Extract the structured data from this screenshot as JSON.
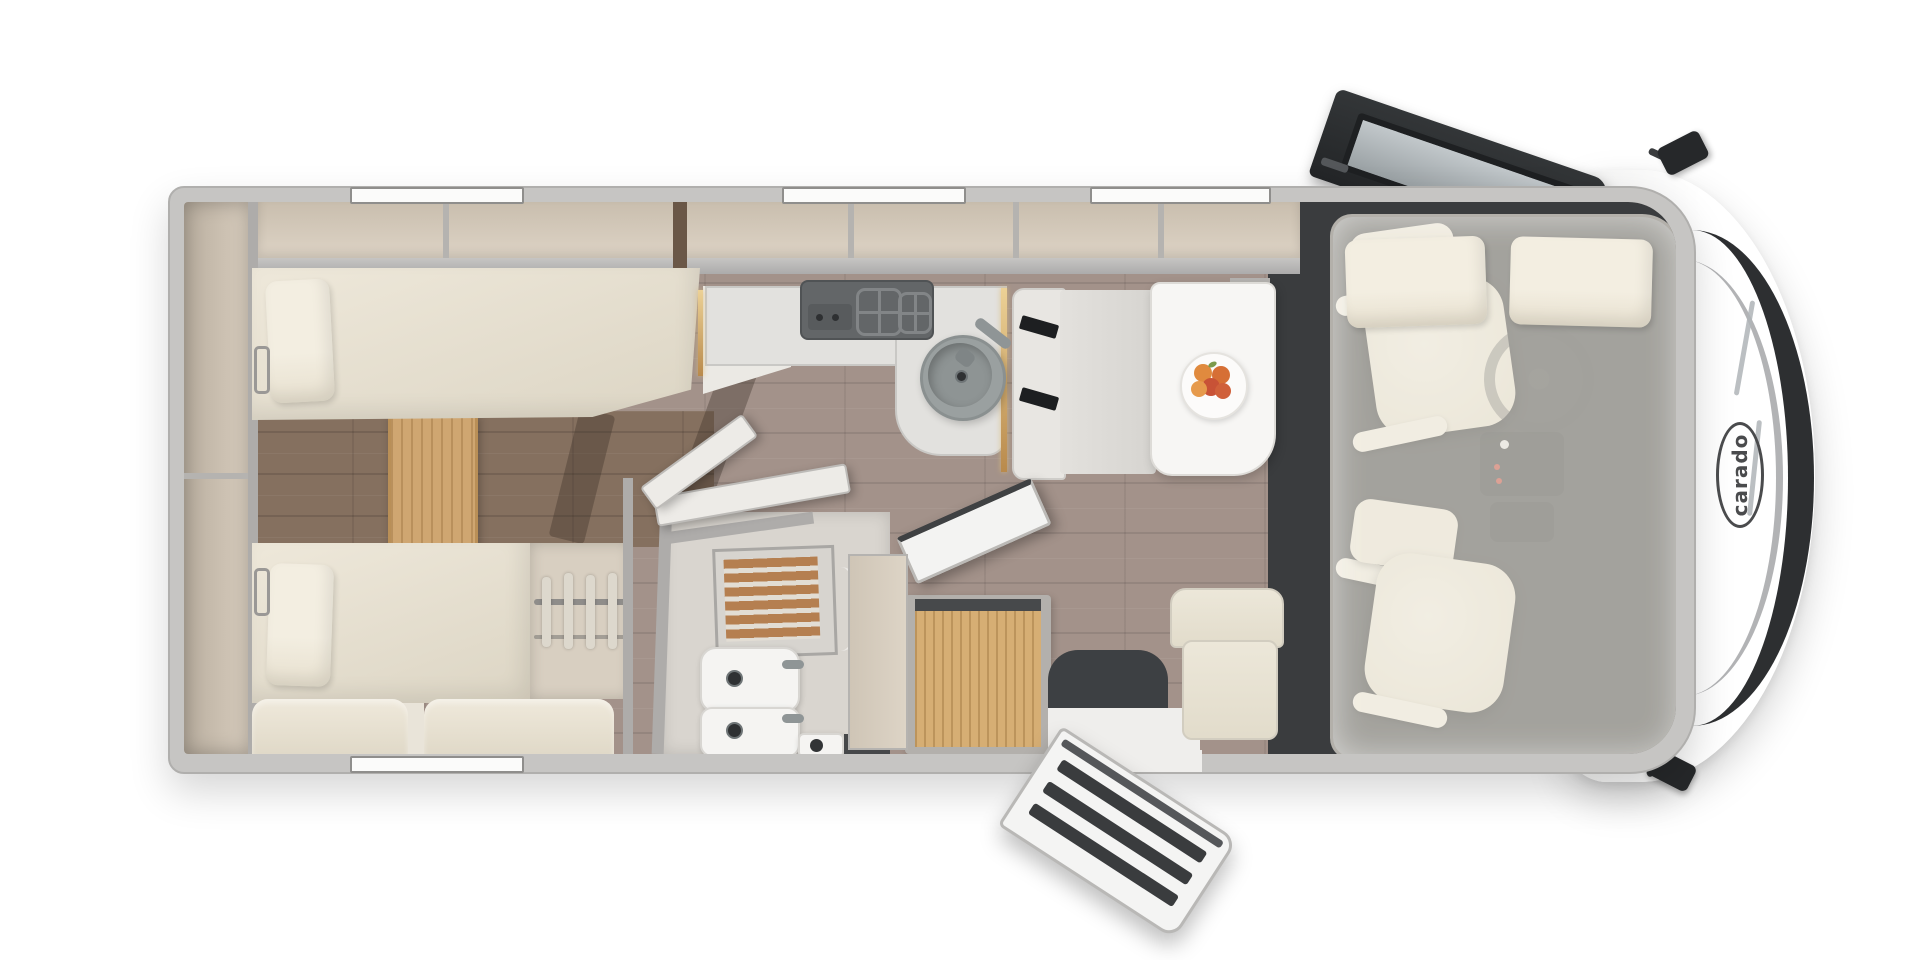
{
  "scene": {
    "description": "Top-down floor plan rendering of a Carado A-class motorhome",
    "brand": {
      "logo_text": "carado",
      "logo_color": "#4a4b4d"
    },
    "colors": {
      "background": "#ffffff",
      "body_shell_gray": "#c6c5c3",
      "hood_white": "#fdfdfd",
      "windshield_dark": "#2d2f31",
      "interior_beige": "#e9e4d9",
      "cabinet_beige": "#d5cabb",
      "upholstery_cream": "#ece6d8",
      "wood_floor_taupe": "#a3928a",
      "wood_floor_dark": "#85705f",
      "wood_step_oak": "#cfa671",
      "shower_teak": "#b57f50",
      "counter_gray": "#e2e1de",
      "accent_brass": "#cda365",
      "cab_mat_charcoal": "#3a3c3e",
      "table_white": "#f7f6f4",
      "fruit_orange": "#e08a3e",
      "seatbelt_black": "#1d1f21"
    }
  }
}
